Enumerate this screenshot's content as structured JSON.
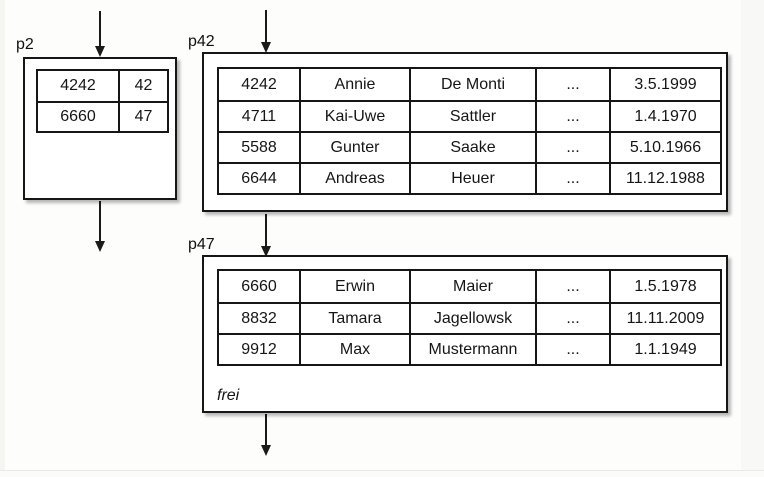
{
  "diagram": {
    "colors": {
      "background": "#fdfdfc",
      "line": "#161616",
      "text": "#111111"
    },
    "pages": [
      {
        "label": "p2",
        "kind": "index-page",
        "rows": [
          [
            "4242",
            "42"
          ],
          [
            "6660",
            "47"
          ]
        ]
      },
      {
        "label": "p42",
        "kind": "data-page",
        "rows": [
          [
            "4242",
            "Annie",
            "De Monti",
            "...",
            "3.5.1999"
          ],
          [
            "4711",
            "Kai-Uwe",
            "Sattler",
            "...",
            "1.4.1970"
          ],
          [
            "5588",
            "Gunter",
            "Saake",
            "...",
            "5.10.1966"
          ],
          [
            "6644",
            "Andreas",
            "Heuer",
            "...",
            "11.12.1988"
          ]
        ]
      },
      {
        "label": "p47",
        "kind": "data-page",
        "free_label": "frei",
        "rows": [
          [
            "6660",
            "Erwin",
            "Maier",
            "...",
            "1.5.1978"
          ],
          [
            "8832",
            "Tamara",
            "Jagellowsk",
            "...",
            "11.11.2009"
          ],
          [
            "9912",
            "Max",
            "Mustermann",
            "...",
            "1.1.1949"
          ]
        ]
      }
    ]
  }
}
